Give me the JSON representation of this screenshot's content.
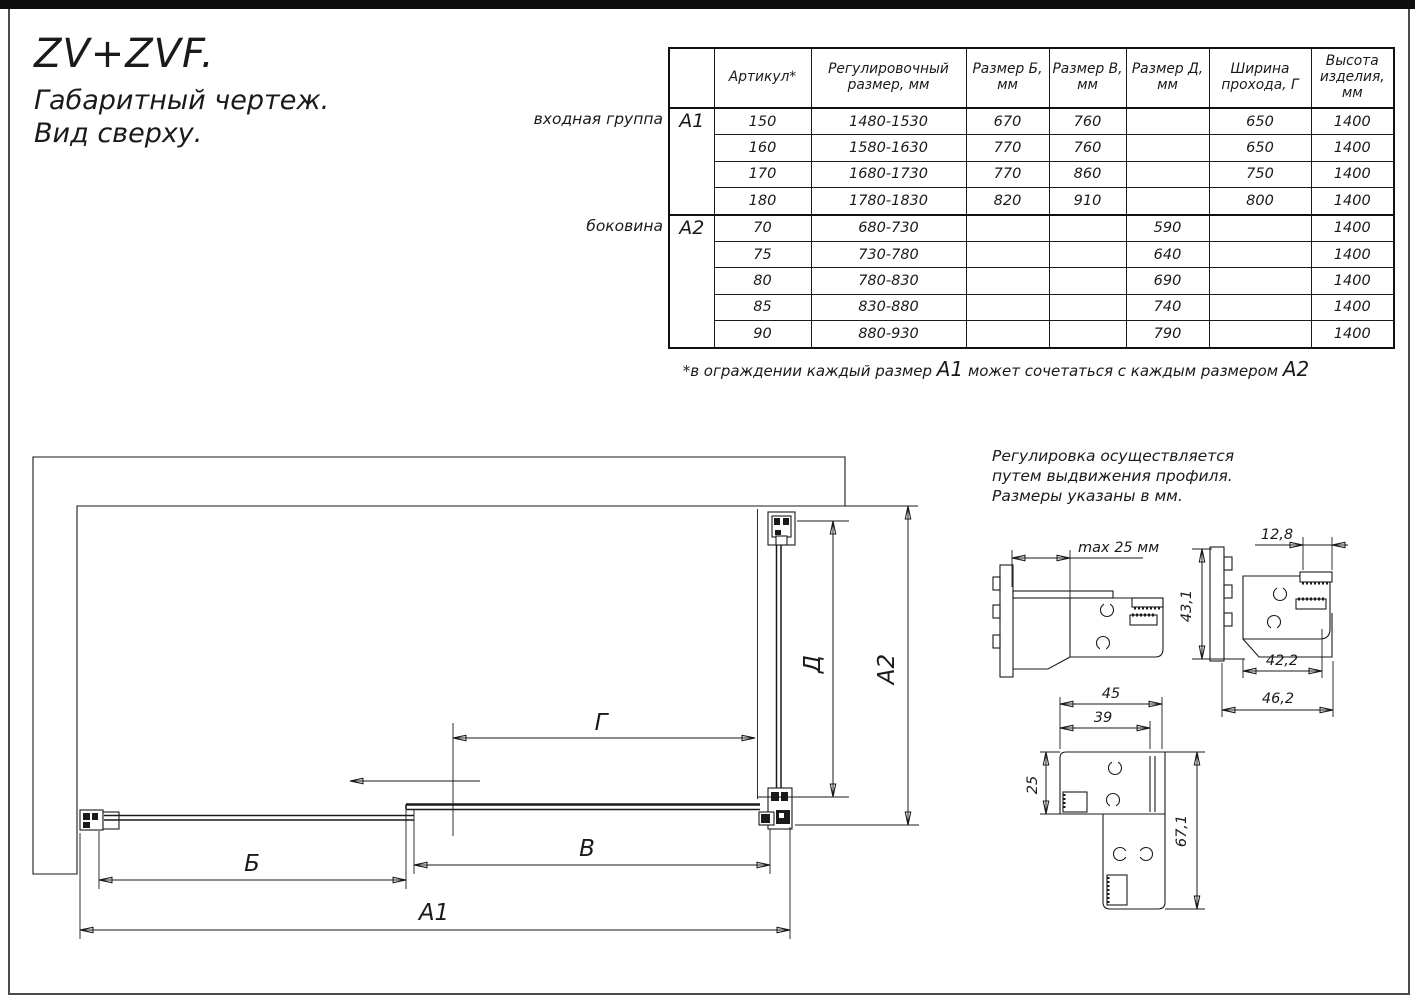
{
  "title": {
    "model": "ZV+ZVF.",
    "line2": "Габаритный чертеж.",
    "line3": "Вид сверху."
  },
  "table": {
    "headers": [
      "",
      "Артикул*",
      "Регулировочный размер, мм",
      "Размер Б, мм",
      "Размер В, мм",
      "Размер Д, мм",
      "Ширина прохода, Г",
      "Высота изделия, мм"
    ],
    "groups": [
      {
        "key": "А1",
        "label": "входная группа",
        "rows": [
          [
            "150",
            "1480-1530",
            "670",
            "760",
            "",
            "650",
            "1400"
          ],
          [
            "160",
            "1580-1630",
            "770",
            "760",
            "",
            "650",
            "1400"
          ],
          [
            "170",
            "1680-1730",
            "770",
            "860",
            "",
            "750",
            "1400"
          ],
          [
            "180",
            "1780-1830",
            "820",
            "910",
            "",
            "800",
            "1400"
          ]
        ]
      },
      {
        "key": "А2",
        "label": "боковина",
        "rows": [
          [
            "70",
            "680-730",
            "",
            "",
            "590",
            "",
            "1400"
          ],
          [
            "75",
            "730-780",
            "",
            "",
            "640",
            "",
            "1400"
          ],
          [
            "80",
            "780-830",
            "",
            "",
            "690",
            "",
            "1400"
          ],
          [
            "85",
            "830-880",
            "",
            "",
            "740",
            "",
            "1400"
          ],
          [
            "90",
            "880-930",
            "",
            "",
            "790",
            "",
            "1400"
          ]
        ]
      }
    ],
    "footnote": {
      "p1": "*в ограждении каждый размер ",
      "b1": "А1",
      "p2": " может сочетаться с каждым размером ",
      "b2": "А2"
    }
  },
  "note": {
    "line1": "Регулировка осуществляется",
    "line2": "путем выдвижения профиля.",
    "line3": "Размеры указаны в мм."
  },
  "plan_dims": {
    "b": "Б",
    "v": "В",
    "a1": "А1",
    "a2": "А2",
    "d": "Д",
    "g": "Г"
  },
  "detail_dims": {
    "max25": "max 25 мм",
    "w128": "12,8",
    "h431": "43,1",
    "w422": "42,2",
    "w462": "46,2",
    "w45": "45",
    "w39": "39",
    "h25": "25",
    "h671": "67,1"
  }
}
